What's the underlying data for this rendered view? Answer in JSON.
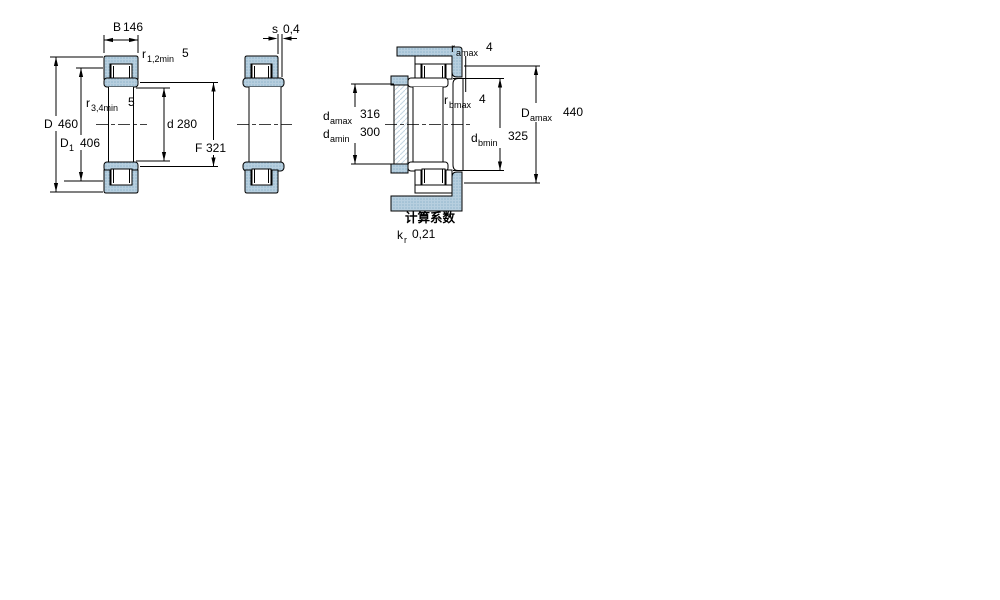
{
  "colors": {
    "outline": "#000000",
    "ring_fill": "#b7cfdf",
    "ring_dot": "#8fb4cb",
    "shaft_hatch_line": "#c4d6e3",
    "background": "#ffffff"
  },
  "dims": {
    "B": {
      "label": "B",
      "value": "146"
    },
    "r12": {
      "label": "r",
      "sub": "1,2min",
      "value": "5"
    },
    "r34": {
      "label": "r",
      "sub": "3,4min",
      "value": "5"
    },
    "d": {
      "label": "d",
      "value": "280"
    },
    "D": {
      "label": "D",
      "value": "460"
    },
    "D1": {
      "label": "D",
      "sub": "1",
      "value": "406"
    },
    "F": {
      "label": "F",
      "value": "321"
    },
    "s": {
      "label": "s",
      "value": "0,4"
    },
    "ramax": {
      "label": "r",
      "sub": "amax",
      "value": "4"
    },
    "rbmax": {
      "label": "r",
      "sub": "bmax",
      "value": "4"
    },
    "damax": {
      "label": "d",
      "sub": "amax",
      "value": "316"
    },
    "damin": {
      "label": "d",
      "sub": "amin",
      "value": "300"
    },
    "dbmin": {
      "label": "d",
      "sub": "bmin",
      "value": "325"
    },
    "Damax": {
      "label": "D",
      "sub": "amax",
      "value": "440"
    }
  },
  "calculation": {
    "heading": "计算系数",
    "kr_label": "k",
    "kr_sub": "r",
    "kr_value": "0,21"
  }
}
